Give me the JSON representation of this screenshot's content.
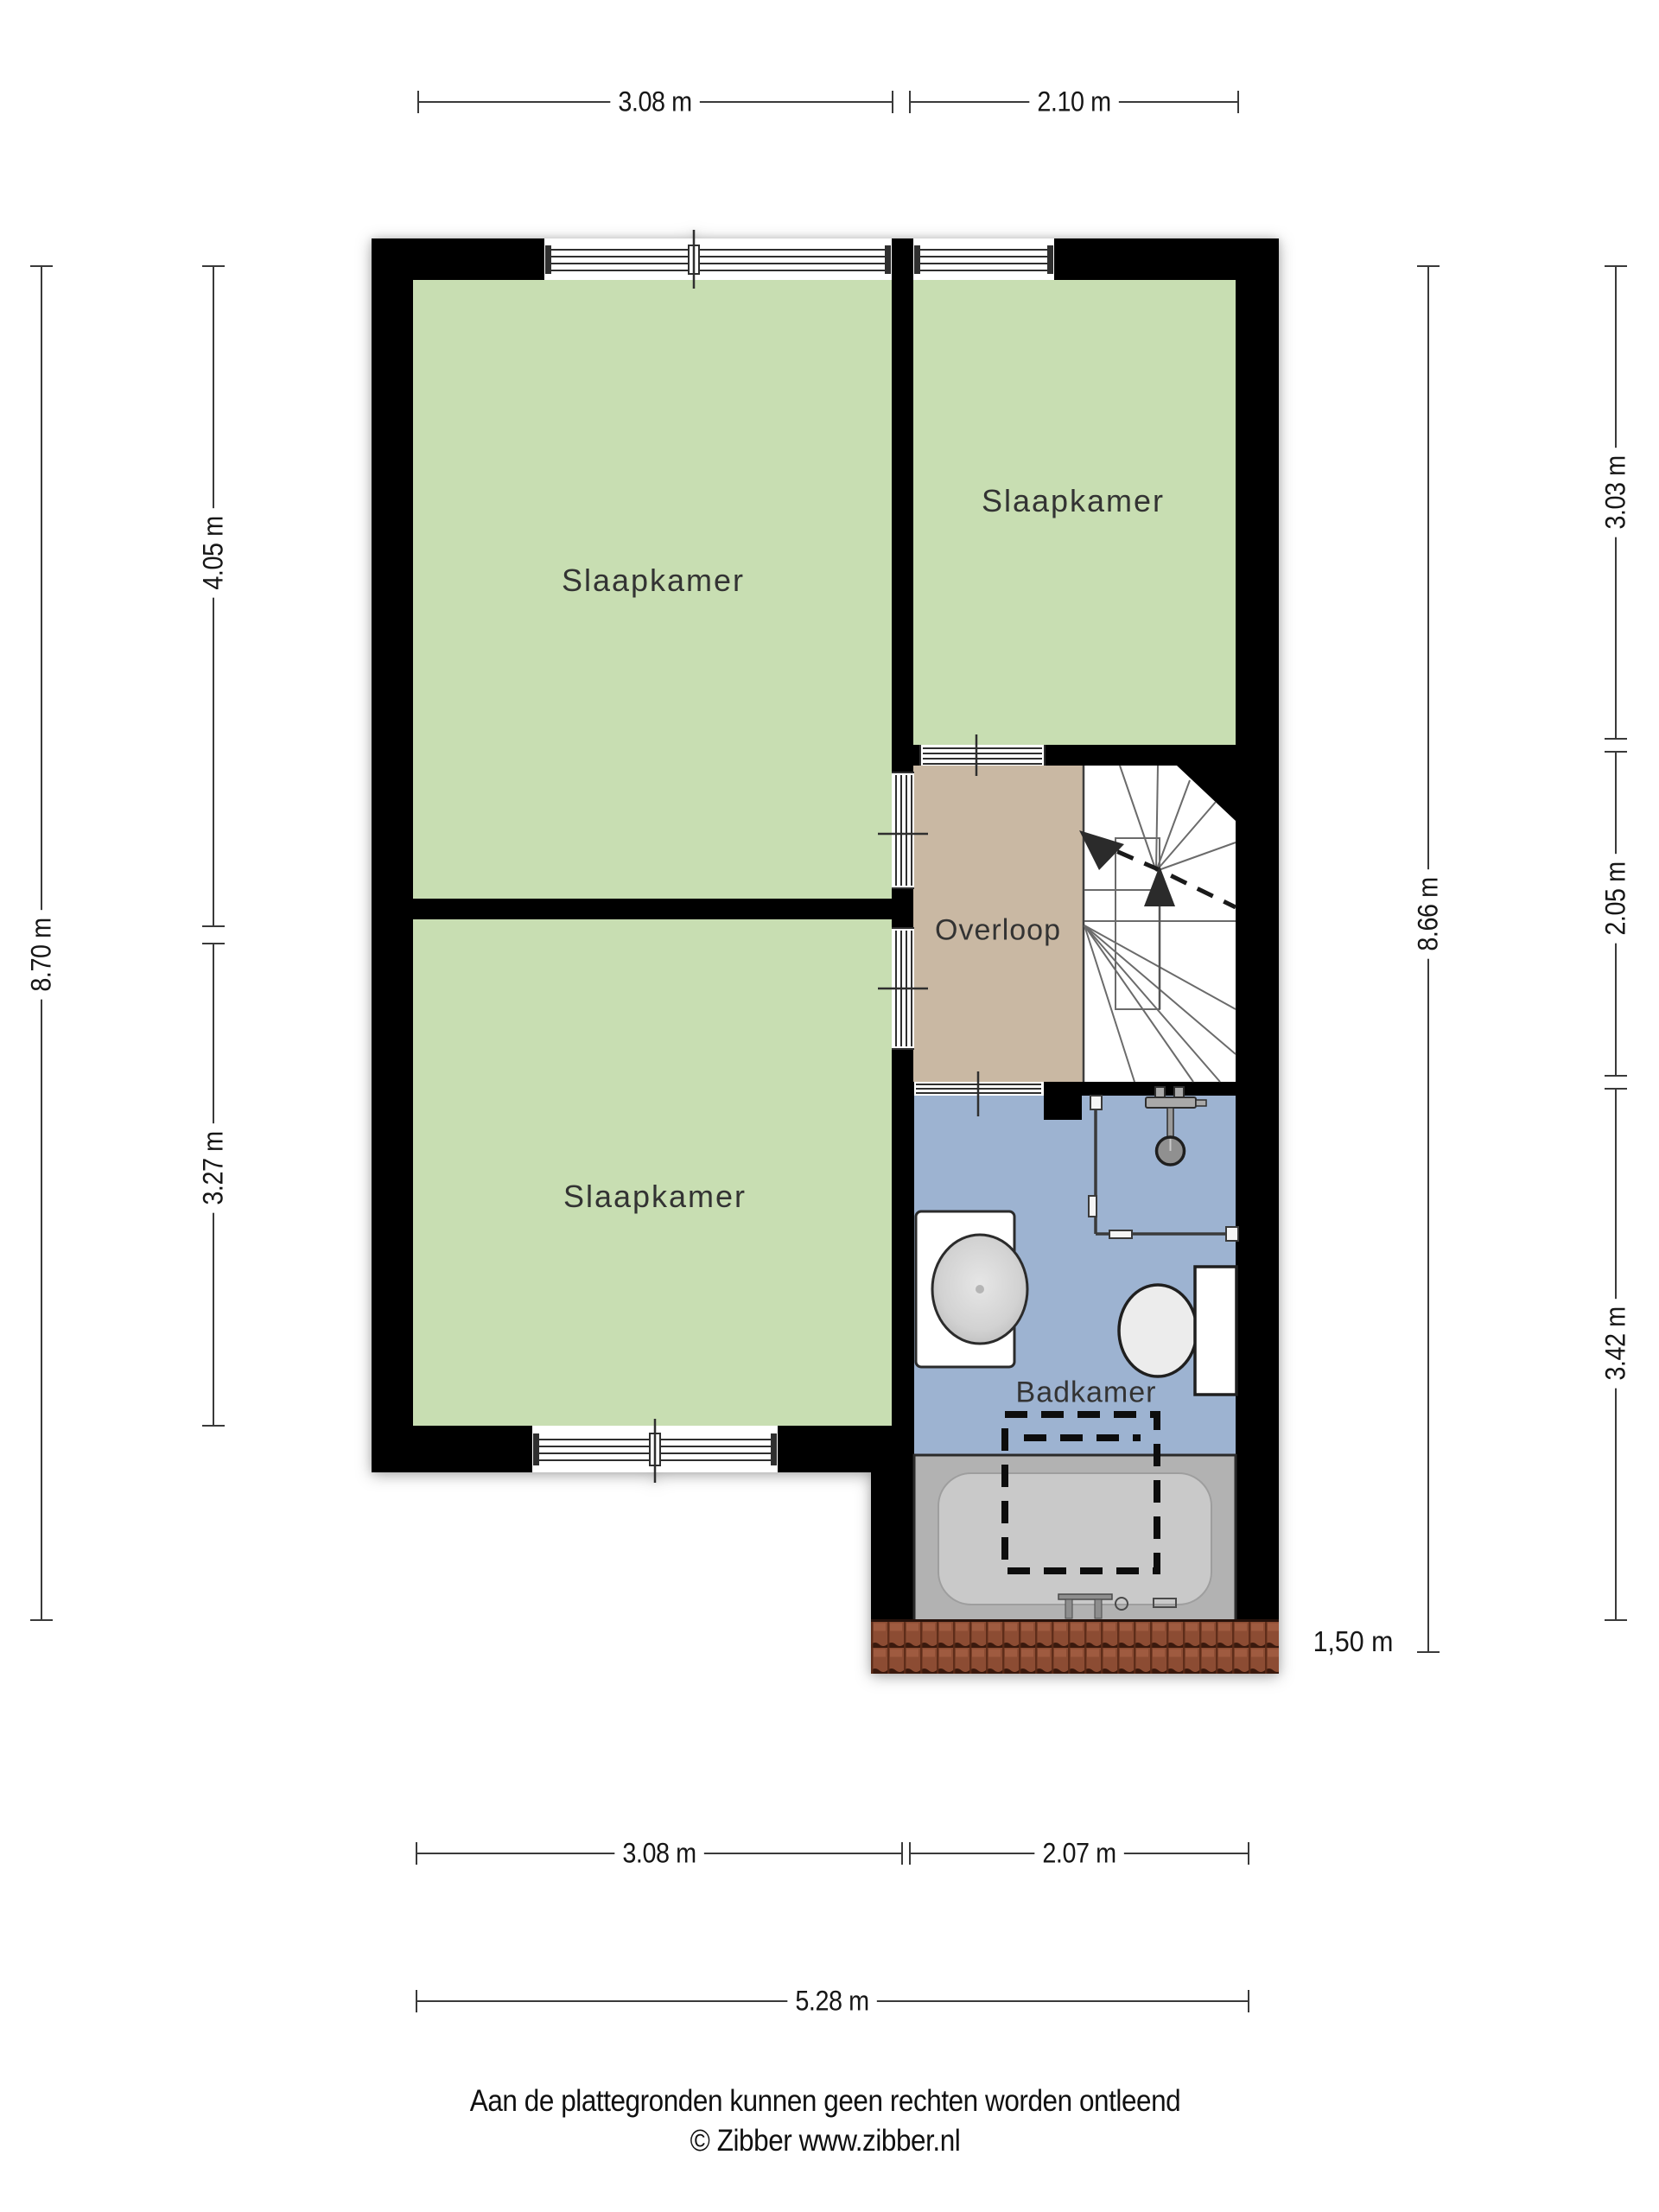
{
  "dimensions": {
    "top": [
      "3.08 m",
      "2.10 m"
    ],
    "bottom": [
      "3.08 m",
      "2.07 m"
    ],
    "bottom_overall": "5.28 m",
    "left_overall": "8.70 m",
    "left_segments": [
      "4.05 m",
      "3.27 m"
    ],
    "right_overall": "8.66 m",
    "right_segments": [
      "3.03 m",
      "2.05 m",
      "3.42 m"
    ],
    "headroom_marker": "1,50 m"
  },
  "rooms": {
    "slaapkamer_groot": "Slaapkamer",
    "slaapkamer_rechtsboven": "Slaapkamer",
    "slaapkamer_linksonder": "Slaapkamer",
    "overloop": "Overloop",
    "badkamer": "Badkamer"
  },
  "fixtures": [
    "staircase",
    "shower",
    "washbasin",
    "toilet",
    "bathtub",
    "roof-edge"
  ],
  "footer": {
    "disclaimer": "Aan de plattegronden kunnen geen rechten worden ontleend",
    "copyright": "© Zibber www.zibber.nl"
  },
  "colors": {
    "wall": "#000000",
    "bedroom_floor": "#c8deb2",
    "landing_floor": "#c9b8a3",
    "bathroom_floor": "#9db3d1",
    "stairs_floor": "#ffffff",
    "roof_tile": "#8c4c33",
    "bathtub": "#b2b2b2"
  }
}
